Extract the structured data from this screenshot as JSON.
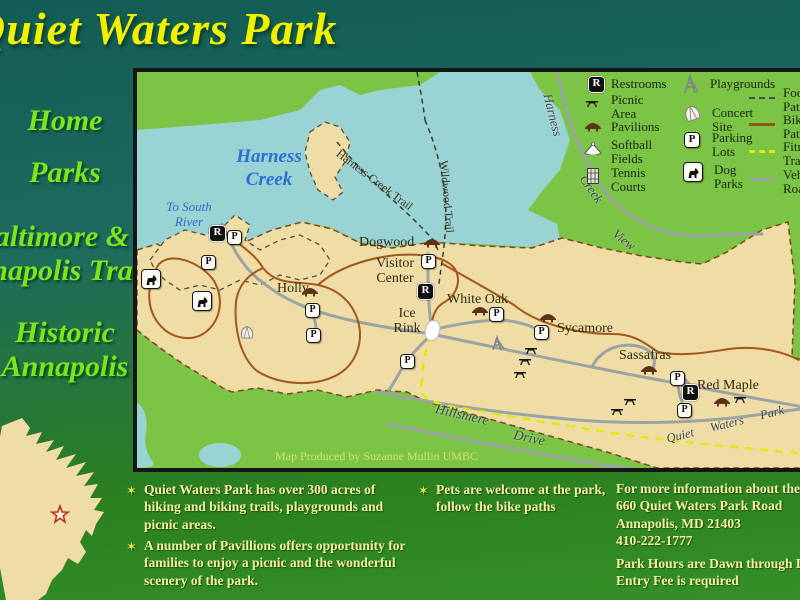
{
  "title": "Quiet Waters Park",
  "nav": {
    "items": [
      {
        "label": "Home"
      },
      {
        "label": "Parks"
      },
      {
        "label": "Baltimore & Annapolis Trail"
      },
      {
        "label": "Historic Annapolis"
      }
    ]
  },
  "map": {
    "credit": "Map Produced by Suzanne Mullin UMBC",
    "water": {
      "to_south_river": "To South River",
      "harness_creek": "Harness Creek"
    },
    "areas": {
      "dogwood": "Dogwood",
      "visitor_center": "Visitor Center",
      "ice_rink": "Ice Rink",
      "white_oak": "White Oak",
      "sycamore": "Sycamore",
      "sassafras": "Sassafras",
      "red_maple": "Red Maple",
      "holly": "Holly"
    },
    "roads": {
      "harness": "Harness",
      "creek": "Creek",
      "view": "View",
      "harness_creek_trail": "Harness Creek Trail",
      "wildwood_trail": "Wildwood Trail",
      "hillsmere": "Hillsmere",
      "drive": "Drive",
      "quiet_waters_park": "Quiet Waters Park R"
    },
    "marker_letters": {
      "restroom": "R",
      "parking": "P"
    }
  },
  "legend": {
    "restrooms": "Restrooms",
    "picnic": "Picnic\nArea",
    "pavilions": "Pavilions",
    "softball": "Softball\nFields",
    "tennis": "Tennis\nCourts",
    "playgrounds": "Playgrounds",
    "concert": "Concert\nSite",
    "parking": "Parking\nLots",
    "dog": "Dog\nParks",
    "foot": "Foot\nPaths",
    "bike": "Bike\nPaths",
    "fitness": "Fitness\nTrail",
    "vehicle": "Vehicle\nRoads"
  },
  "info": {
    "bullet_char": "✶",
    "bullets": [
      "Quiet Waters Park has over 300 acres of hiking and biking trails, playgrounds and picnic areas.",
      "A number of Pavillions offers opportunity for families to enjoy a picnic and the wonderful scenery of the park.",
      "Pets are welcome at the park, follow the bike paths"
    ],
    "contact": [
      "For more information about the park",
      "660 Quiet Waters Park Road",
      "Annapolis, MD 21403",
      "410-222-1777"
    ],
    "hours": [
      "Park Hours are Dawn through Dusk",
      "Entry Fee is required"
    ]
  },
  "colors": {
    "background_top": "#135c55",
    "background_bottom": "#349026",
    "title_yellow": "#f0f000",
    "nav_green": "#7ce61c",
    "map_green": "#7cc445",
    "water": "#9ad3d3",
    "land_tan": "#f0dda6",
    "info_text": "#f2f0a0"
  }
}
